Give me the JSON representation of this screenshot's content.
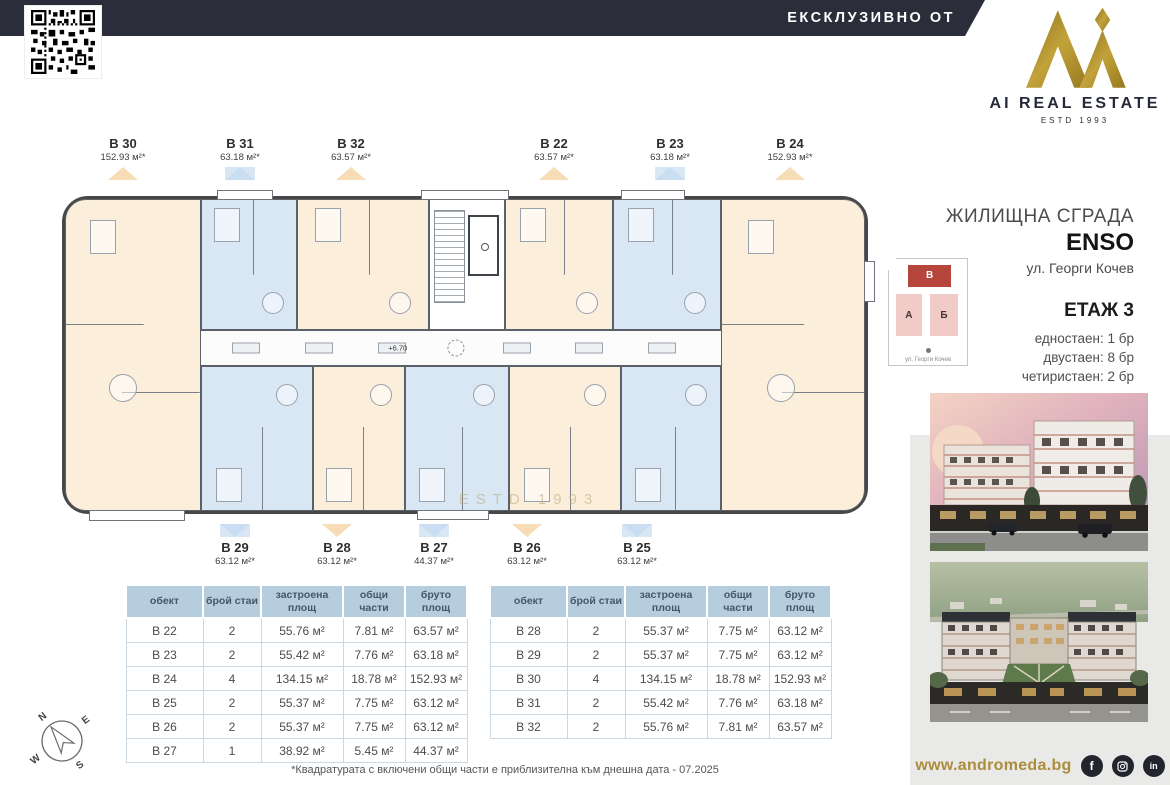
{
  "header": {
    "exclusive_label": "ЕКСКЛУЗИВНО ОТ",
    "brand_name": "AI REAL ESTATE",
    "brand_estd": "ESTD 1993"
  },
  "project": {
    "building_type": "ЖИЛИЩНА СГРАДА",
    "name": "ENSO",
    "address": "ул. Георги Кочев",
    "floor_title": "ЕТАЖ 3",
    "unit_mix": [
      "едностаен: 1 бр",
      "двустаен: 8 бр",
      "четиристаен: 2 бр"
    ],
    "site_plan": {
      "block_a": "А",
      "block_b": "Б",
      "block_v": "В",
      "street": "ул. Георги Кочев"
    }
  },
  "plan": {
    "level_mark": "+6.70",
    "watermark_estd": "ESTD 1993",
    "top_units": [
      {
        "id": "B 30",
        "area": "152.93 м²*",
        "accent": "orange"
      },
      {
        "id": "B 31",
        "area": "63.18 м²*",
        "accent": "blue"
      },
      {
        "id": "B 32",
        "area": "63.57 м²*",
        "accent": "orange"
      },
      {
        "id": "B 22",
        "area": "63.57 м²*",
        "accent": "orange"
      },
      {
        "id": "B 23",
        "area": "63.18 м²*",
        "accent": "blue"
      },
      {
        "id": "B 24",
        "area": "152.93 м²*",
        "accent": "orange"
      }
    ],
    "bottom_units": [
      {
        "id": "B 29",
        "area": "63.12 м²*",
        "accent": "blue"
      },
      {
        "id": "B 28",
        "area": "63.12 м²*",
        "accent": "orange"
      },
      {
        "id": "B 27",
        "area": "44.37 м²*",
        "accent": "blue"
      },
      {
        "id": "B 26",
        "area": "63.12 м²*",
        "accent": "orange"
      },
      {
        "id": "B 25",
        "area": "63.12 м²*",
        "accent": "blue"
      }
    ]
  },
  "table_headers": [
    "обект",
    "брой стаи",
    "застроена площ",
    "общи части",
    "бруто площ"
  ],
  "tables": [
    {
      "rows": [
        [
          "B 22",
          "2",
          "55.76 м²",
          "7.81 м²",
          "63.57 м²"
        ],
        [
          "B 23",
          "2",
          "55.42 м²",
          "7.76 м²",
          "63.18 м²"
        ],
        [
          "B 24",
          "4",
          "134.15 м²",
          "18.78 м²",
          "152.93 м²"
        ],
        [
          "B 25",
          "2",
          "55.37 м²",
          "7.75 м²",
          "63.12 м²"
        ],
        [
          "B 26",
          "2",
          "55.37 м²",
          "7.75 м²",
          "63.12 м²"
        ],
        [
          "B 27",
          "1",
          "38.92 м²",
          "5.45 м²",
          "44.37 м²"
        ]
      ]
    },
    {
      "rows": [
        [
          "B 28",
          "2",
          "55.37 м²",
          "7.75 м²",
          "63.12 м²"
        ],
        [
          "B 29",
          "2",
          "55.37 м²",
          "7.75 м²",
          "63.12 м²"
        ],
        [
          "B 30",
          "4",
          "134.15 м²",
          "18.78 м²",
          "152.93 м²"
        ],
        [
          "B 31",
          "2",
          "55.42 м²",
          "7.76 м²",
          "63.18 м²"
        ],
        [
          "B 32",
          "2",
          "55.76 м²",
          "7.81 м²",
          "63.57 м²"
        ]
      ]
    }
  ],
  "footnote": "*Квадратурата с включени общи части е приблизителна към днешна дата - 07.2025",
  "footer": {
    "website": "www.andromeda.bg"
  },
  "compass": {
    "n": "N",
    "e": "E",
    "s": "S",
    "w": "W"
  },
  "colors": {
    "navy": "#2b2d3a",
    "gold": "#a98b32",
    "cream_unit": "#fbeeda",
    "blue_unit": "#d9e7f4",
    "accent_orange": "#f7ddb6",
    "accent_blue": "#c9def2",
    "table_header": "#b5cddc",
    "site_red": "#b6453c",
    "site_pink": "#f0cbc8"
  }
}
